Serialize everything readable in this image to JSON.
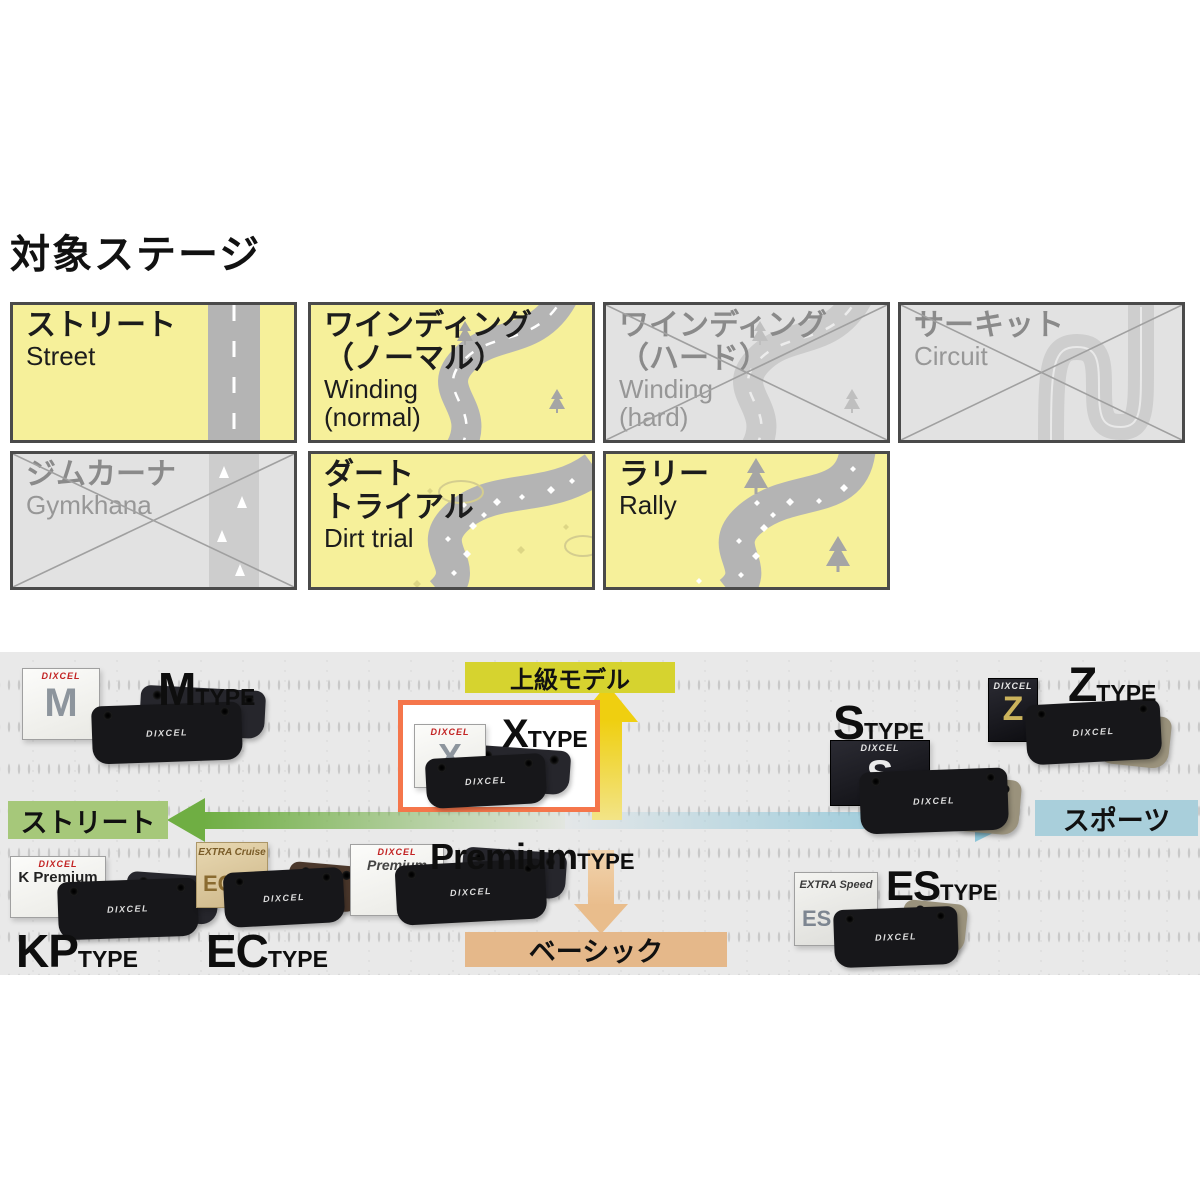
{
  "title": "対象ステージ",
  "stages": [
    {
      "jp1": "ストリート",
      "en1": "Street",
      "status": "active"
    },
    {
      "jp1": "ワインディング",
      "jp2": "（ノーマル）",
      "en1": "Winding",
      "en2": "(normal)",
      "status": "active"
    },
    {
      "jp1": "ワインディング",
      "jp2": "（ハード）",
      "en1": "Winding",
      "en2": "(hard)",
      "status": "inactive"
    },
    {
      "jp1": "サーキット",
      "en1": "Circuit",
      "status": "inactive"
    },
    {
      "jp1": "ジムカーナ",
      "en1": "Gymkhana",
      "status": "inactive"
    },
    {
      "jp1": "ダート",
      "jp2": "トライアル",
      "en1": "Dirt trial",
      "status": "active"
    },
    {
      "jp1": "ラリー",
      "en1": "Rally",
      "status": "active"
    }
  ],
  "chart": {
    "brand": "DIXCEL",
    "axis": {
      "left": "ストリート",
      "right": "スポーツ",
      "top": "上級モデル",
      "bottom": "ベーシック"
    },
    "types": {
      "m": {
        "letter": "M",
        "suffix": "TYPE",
        "box_letter": "M"
      },
      "x": {
        "letter": "X",
        "suffix": "TYPE",
        "box_letter": "X",
        "highlighted": true
      },
      "z": {
        "letter": "Z",
        "suffix": "TYPE",
        "box_letter": "Z"
      },
      "s": {
        "letter": "S",
        "suffix": "TYPE",
        "box_letter": "S"
      },
      "premium": {
        "letter": "Premium",
        "suffix": "TYPE",
        "box_label": "Premium"
      },
      "kp": {
        "letter": "KP",
        "suffix": "TYPE",
        "box_label": "K Premium"
      },
      "ec": {
        "letter": "EC",
        "suffix": "TYPE",
        "box_title": "EXTRA Cruise",
        "box_letter": "EC"
      },
      "es": {
        "letter": "ES",
        "suffix": "TYPE",
        "box_title": "EXTRA Speed",
        "box_letter": "ES"
      }
    },
    "colors": {
      "stage_active_bg": "#f6f09a",
      "stage_inactive_bg": "#e2e2e2",
      "highlight_border": "#f5764b",
      "axis_top_bg": "#d6d32f",
      "axis_bottom_bg": "#e5b88a",
      "axis_left_bg": "#a6c87a",
      "axis_right_bg": "#a9cfdb",
      "arrow_green": "#6fae43",
      "arrow_blue": "#8cc5d8",
      "arrow_yellow": "#efcf10",
      "arrow_tan": "#e9bd8c"
    }
  }
}
